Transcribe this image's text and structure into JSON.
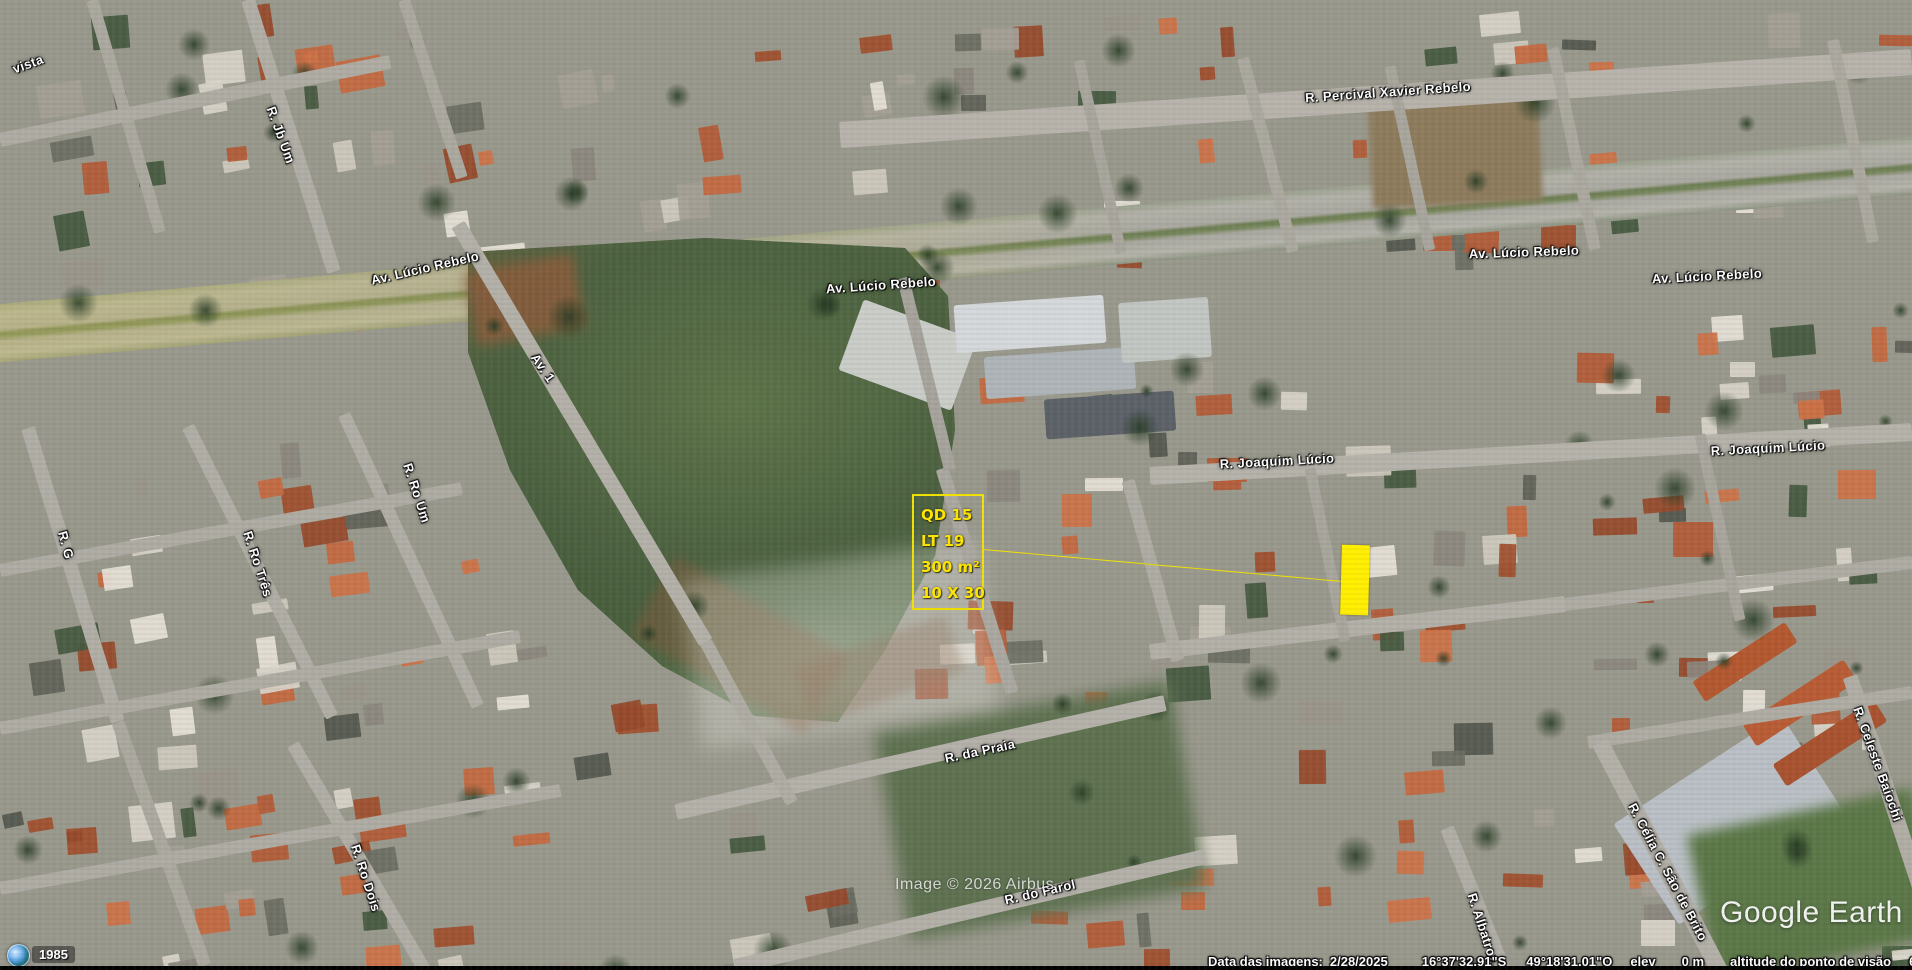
{
  "app": {
    "name": "Google Earth"
  },
  "map": {
    "imagery_credit": "Image © 2026 Airbus",
    "street_labels": [
      {
        "text": "R. Percival Xavier Rebelo",
        "cx": 1388,
        "cy": 92,
        "rot": -4
      },
      {
        "text": "Av. Lúcio Rebelo",
        "cx": 425,
        "cy": 268,
        "rot": -13
      },
      {
        "text": "Av. Lúcio Rebelo",
        "cx": 881,
        "cy": 285,
        "rot": -4
      },
      {
        "text": "Av. Lúcio Rebelo",
        "cx": 1524,
        "cy": 252,
        "rot": -2
      },
      {
        "text": "Av. Lúcio Rebelo",
        "cx": 1707,
        "cy": 276,
        "rot": -3
      },
      {
        "text": "R. Joaquim Lúcio",
        "cx": 1277,
        "cy": 461,
        "rot": -3
      },
      {
        "text": "R. Joaquim Lúcio",
        "cx": 1768,
        "cy": 448,
        "rot": -3
      },
      {
        "text": "R. Jb Um",
        "cx": 281,
        "cy": 135,
        "rot": 70
      },
      {
        "text": "R. G",
        "cx": 66,
        "cy": 545,
        "rot": 75
      },
      {
        "text": "Av. 1",
        "cx": 543,
        "cy": 368,
        "rot": 55
      },
      {
        "text": "R. Ro Um",
        "cx": 417,
        "cy": 493,
        "rot": 72
      },
      {
        "text": "R. Ro Três",
        "cx": 258,
        "cy": 564,
        "rot": 72
      },
      {
        "text": "R. Ro Dois",
        "cx": 366,
        "cy": 878,
        "rot": 72
      },
      {
        "text": "R. da Praia",
        "cx": 980,
        "cy": 751,
        "rot": -12
      },
      {
        "text": "R. do Farol",
        "cx": 1040,
        "cy": 892,
        "rot": -13
      },
      {
        "text": "R. Albatroz",
        "cx": 1483,
        "cy": 928,
        "rot": 72
      },
      {
        "text": "R. Celeste Baiochi",
        "cx": 1878,
        "cy": 764,
        "rot": 70
      },
      {
        "text": "R. Célia C. São de Brito",
        "cx": 1668,
        "cy": 872,
        "rot": 62
      },
      {
        "text": "vista",
        "cx": 28,
        "cy": 64,
        "rot": -20
      }
    ]
  },
  "annotation": {
    "accent_color": "#ffe600",
    "box_lines": [
      "QD 15",
      "LT 19",
      "300 m²",
      "10 X 30"
    ]
  },
  "logo": {
    "text": "Google Earth"
  },
  "history": {
    "year": "1985"
  },
  "status_bar": {
    "imagery_date_label": "Data das imagens:",
    "imagery_date": "2/28/2025",
    "latitude": "16°37'32.91\"S",
    "longitude": "49°18'31.01\"O",
    "elevation_label": "elev",
    "elevation": "0 m",
    "view_altitude_label": "altitude do ponto de visão",
    "view_altitude": "683 m"
  }
}
